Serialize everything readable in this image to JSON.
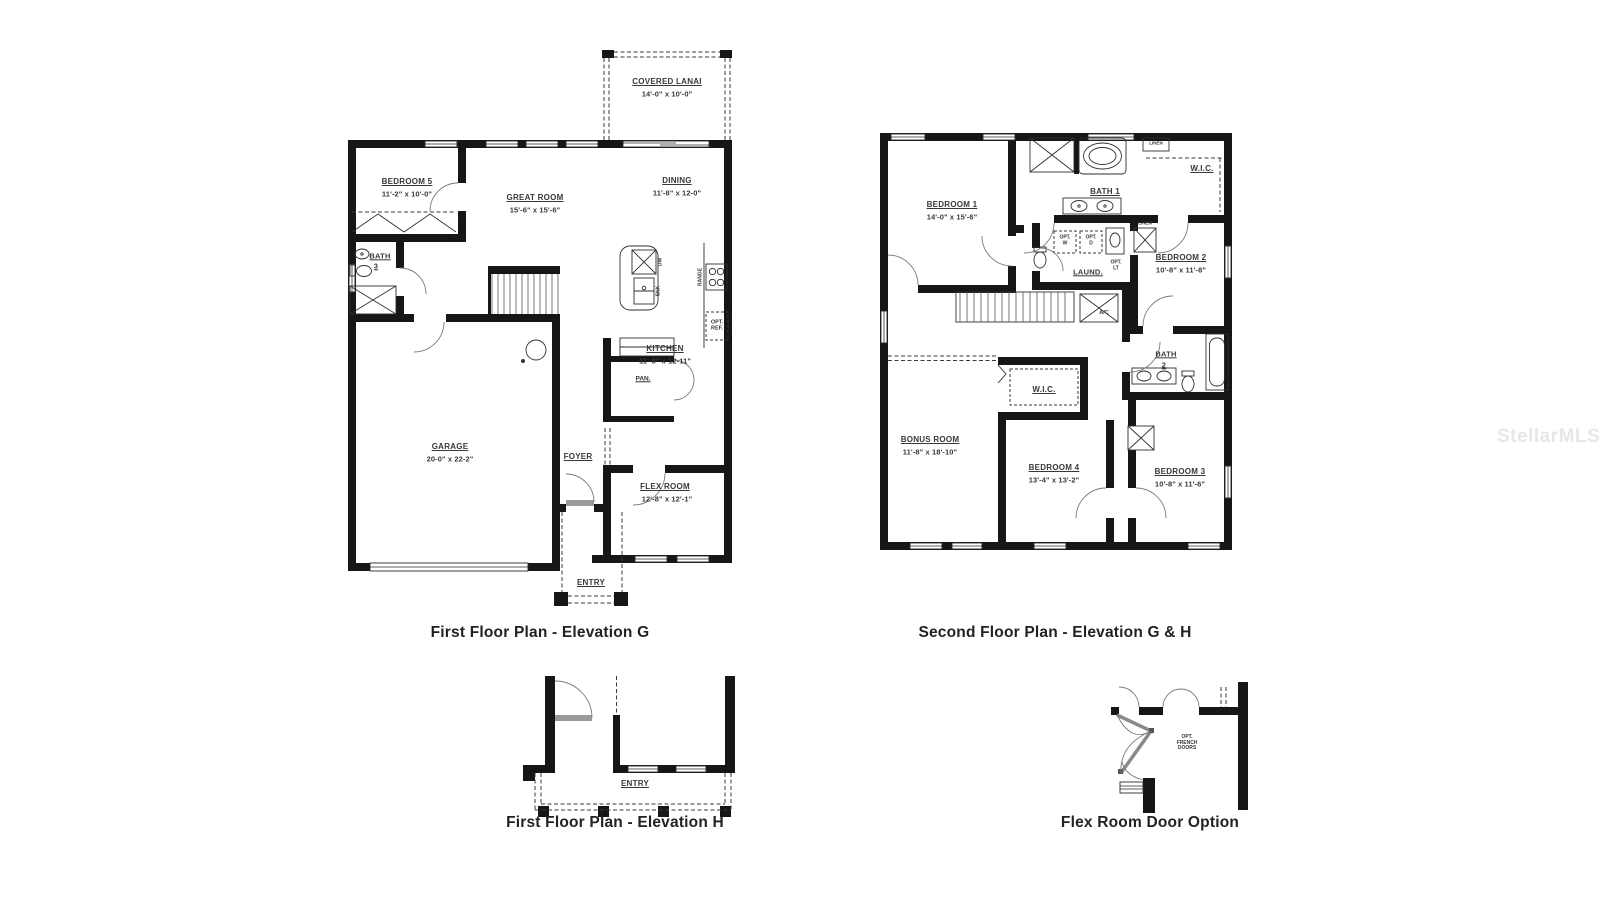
{
  "watermark": "StellarMLS",
  "plan1": {
    "title": "First Floor Plan - Elevation G",
    "rooms": {
      "lanai_name": "COVERED LANAI",
      "lanai_dims": "14'-0\" x 10'-0\"",
      "bed5_name": "BEDROOM 5",
      "bed5_dims": "11'-2\" x 10'-0\"",
      "great_name": "GREAT ROOM",
      "great_dims": "15'-6\" x 15'-6\"",
      "dining_name": "DINING",
      "dining_dims": "11'-8\" x 12-0\"",
      "bath3_name": "BATH",
      "bath3_num": "3",
      "kitchen_name": "KITCHEN",
      "kitchen_dims": "11'-8\" x 12-11\"",
      "pantry": "PAN.",
      "garage_name": "GARAGE",
      "garage_dims": "20-0\" x 22-2\"",
      "foyer": "FOYER",
      "flex_name": "FLEX ROOM",
      "flex_dims": "12'-8\" x 12'-1\"",
      "entry": "ENTRY"
    },
    "fixtures": {
      "opt_ref": "OPT.\nREF.",
      "range": "RANGE",
      "dw": "DW",
      "snk": "SNK"
    }
  },
  "plan2": {
    "title": "Second Floor Plan - Elevation G & H",
    "rooms": {
      "bed1_name": "BEDROOM 1",
      "bed1_dims": "14'-0\" x 15'-6\"",
      "bath1": "BATH 1",
      "wic1": "W.I.C.",
      "linen1": "LINEN",
      "linen2": "LINEN",
      "laund": "LAUND.",
      "bed2_name": "BEDROOM 2",
      "bed2_dims": "10'-8\" x 11'-8\"",
      "bonus_name": "BONUS ROOM",
      "bonus_dims": "11'-8\" x 18'-10\"",
      "wic2": "W.I.C.",
      "bed4_name": "BEDROOM 4",
      "bed4_dims": "13'-4\" x 13'-2\"",
      "bath2_name": "BATH",
      "bath2_num": "2",
      "bed3_name": "BEDROOM 3",
      "bed3_dims": "10'-8\" x 11'-6\"",
      "ac": "A/C"
    },
    "fixtures": {
      "opt_w": "OPT.\nW",
      "opt_d": "OPT.\nD",
      "opt_lt": "OPT.\nLT"
    }
  },
  "plan3": {
    "title": "First Floor Plan - Elevation H",
    "rooms": {
      "entry": "ENTRY"
    }
  },
  "plan4": {
    "title": "Flex Room Door Option",
    "labels": {
      "opt_french": "OPT.\nFRENCH\nDOORS"
    }
  }
}
